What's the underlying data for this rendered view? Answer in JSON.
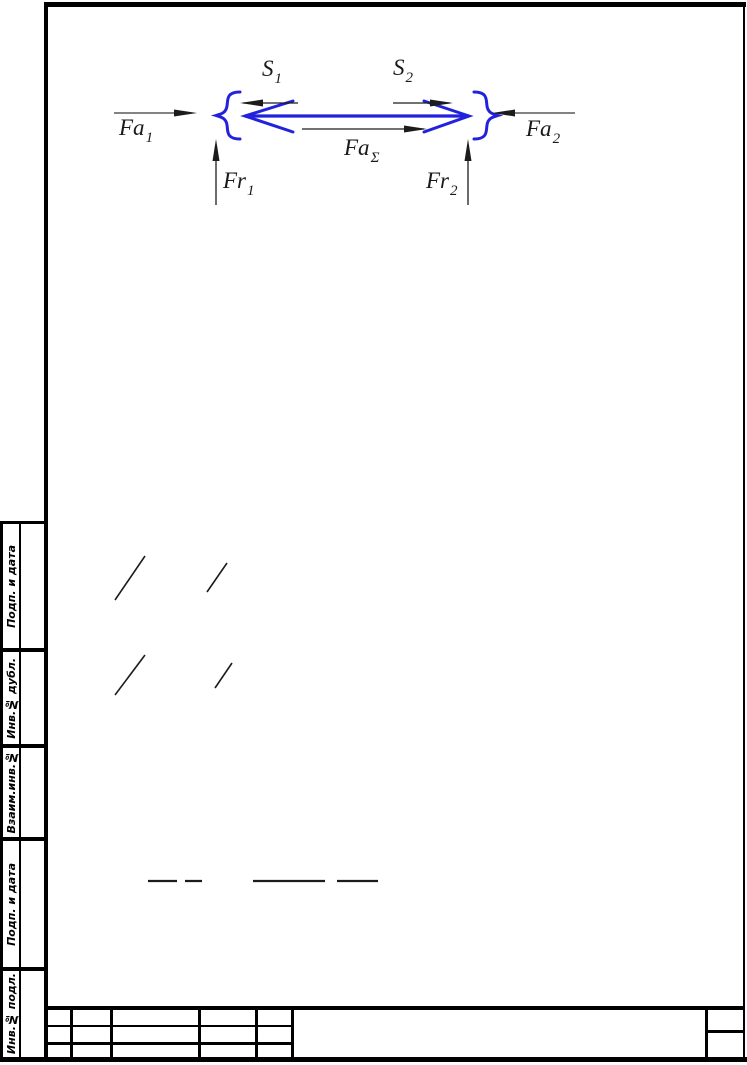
{
  "colors": {
    "accent_blue": "#2222dd",
    "frame_black": "#000000"
  },
  "diagram": {
    "labels": {
      "s1": {
        "main": "S",
        "sub": "1"
      },
      "s2": {
        "main": "S",
        "sub": "2"
      },
      "fa1": {
        "main": "Fa",
        "sub": "1"
      },
      "fa2": {
        "main": "Fa",
        "sub": "2"
      },
      "fa_sum": {
        "main": "Fa",
        "sub": "Σ"
      },
      "fr1": {
        "main": "Fr",
        "sub": "1"
      },
      "fr2": {
        "main": "Fr",
        "sub": "2"
      }
    }
  },
  "sidebar": {
    "cells": [
      {
        "label": "Подп. и дата"
      },
      {
        "label": "Инв.№ дубл."
      },
      {
        "label": "Взаим.инв.№"
      },
      {
        "label": "Подп. и дата"
      },
      {
        "label": "Инв.№ подл."
      }
    ]
  }
}
